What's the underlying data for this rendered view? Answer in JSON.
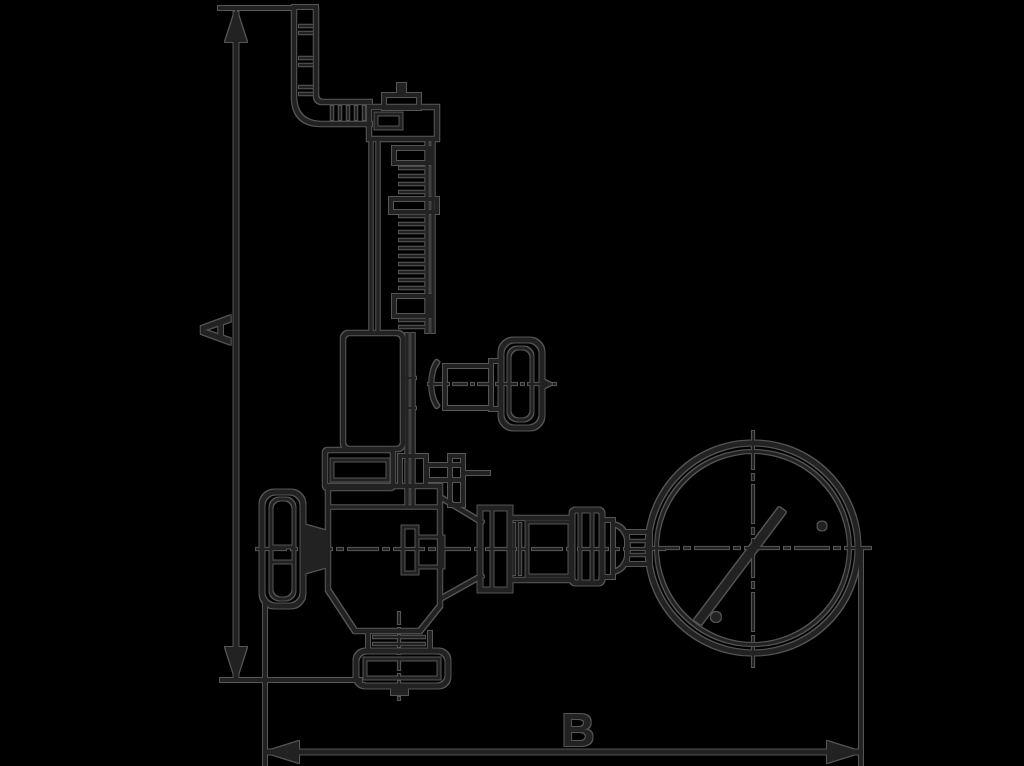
{
  "figure": {
    "kind": "dimensioned-technical-line-drawing",
    "subject": "angle safety valve with bent discharge pipe, threaded spring column, two handwheels and a pressure gauge",
    "labels": {
      "height_dimension": "A",
      "width_dimension": "B"
    }
  },
  "colors": {
    "background": "#000000",
    "ink": "#242021",
    "halo": "#555555"
  }
}
